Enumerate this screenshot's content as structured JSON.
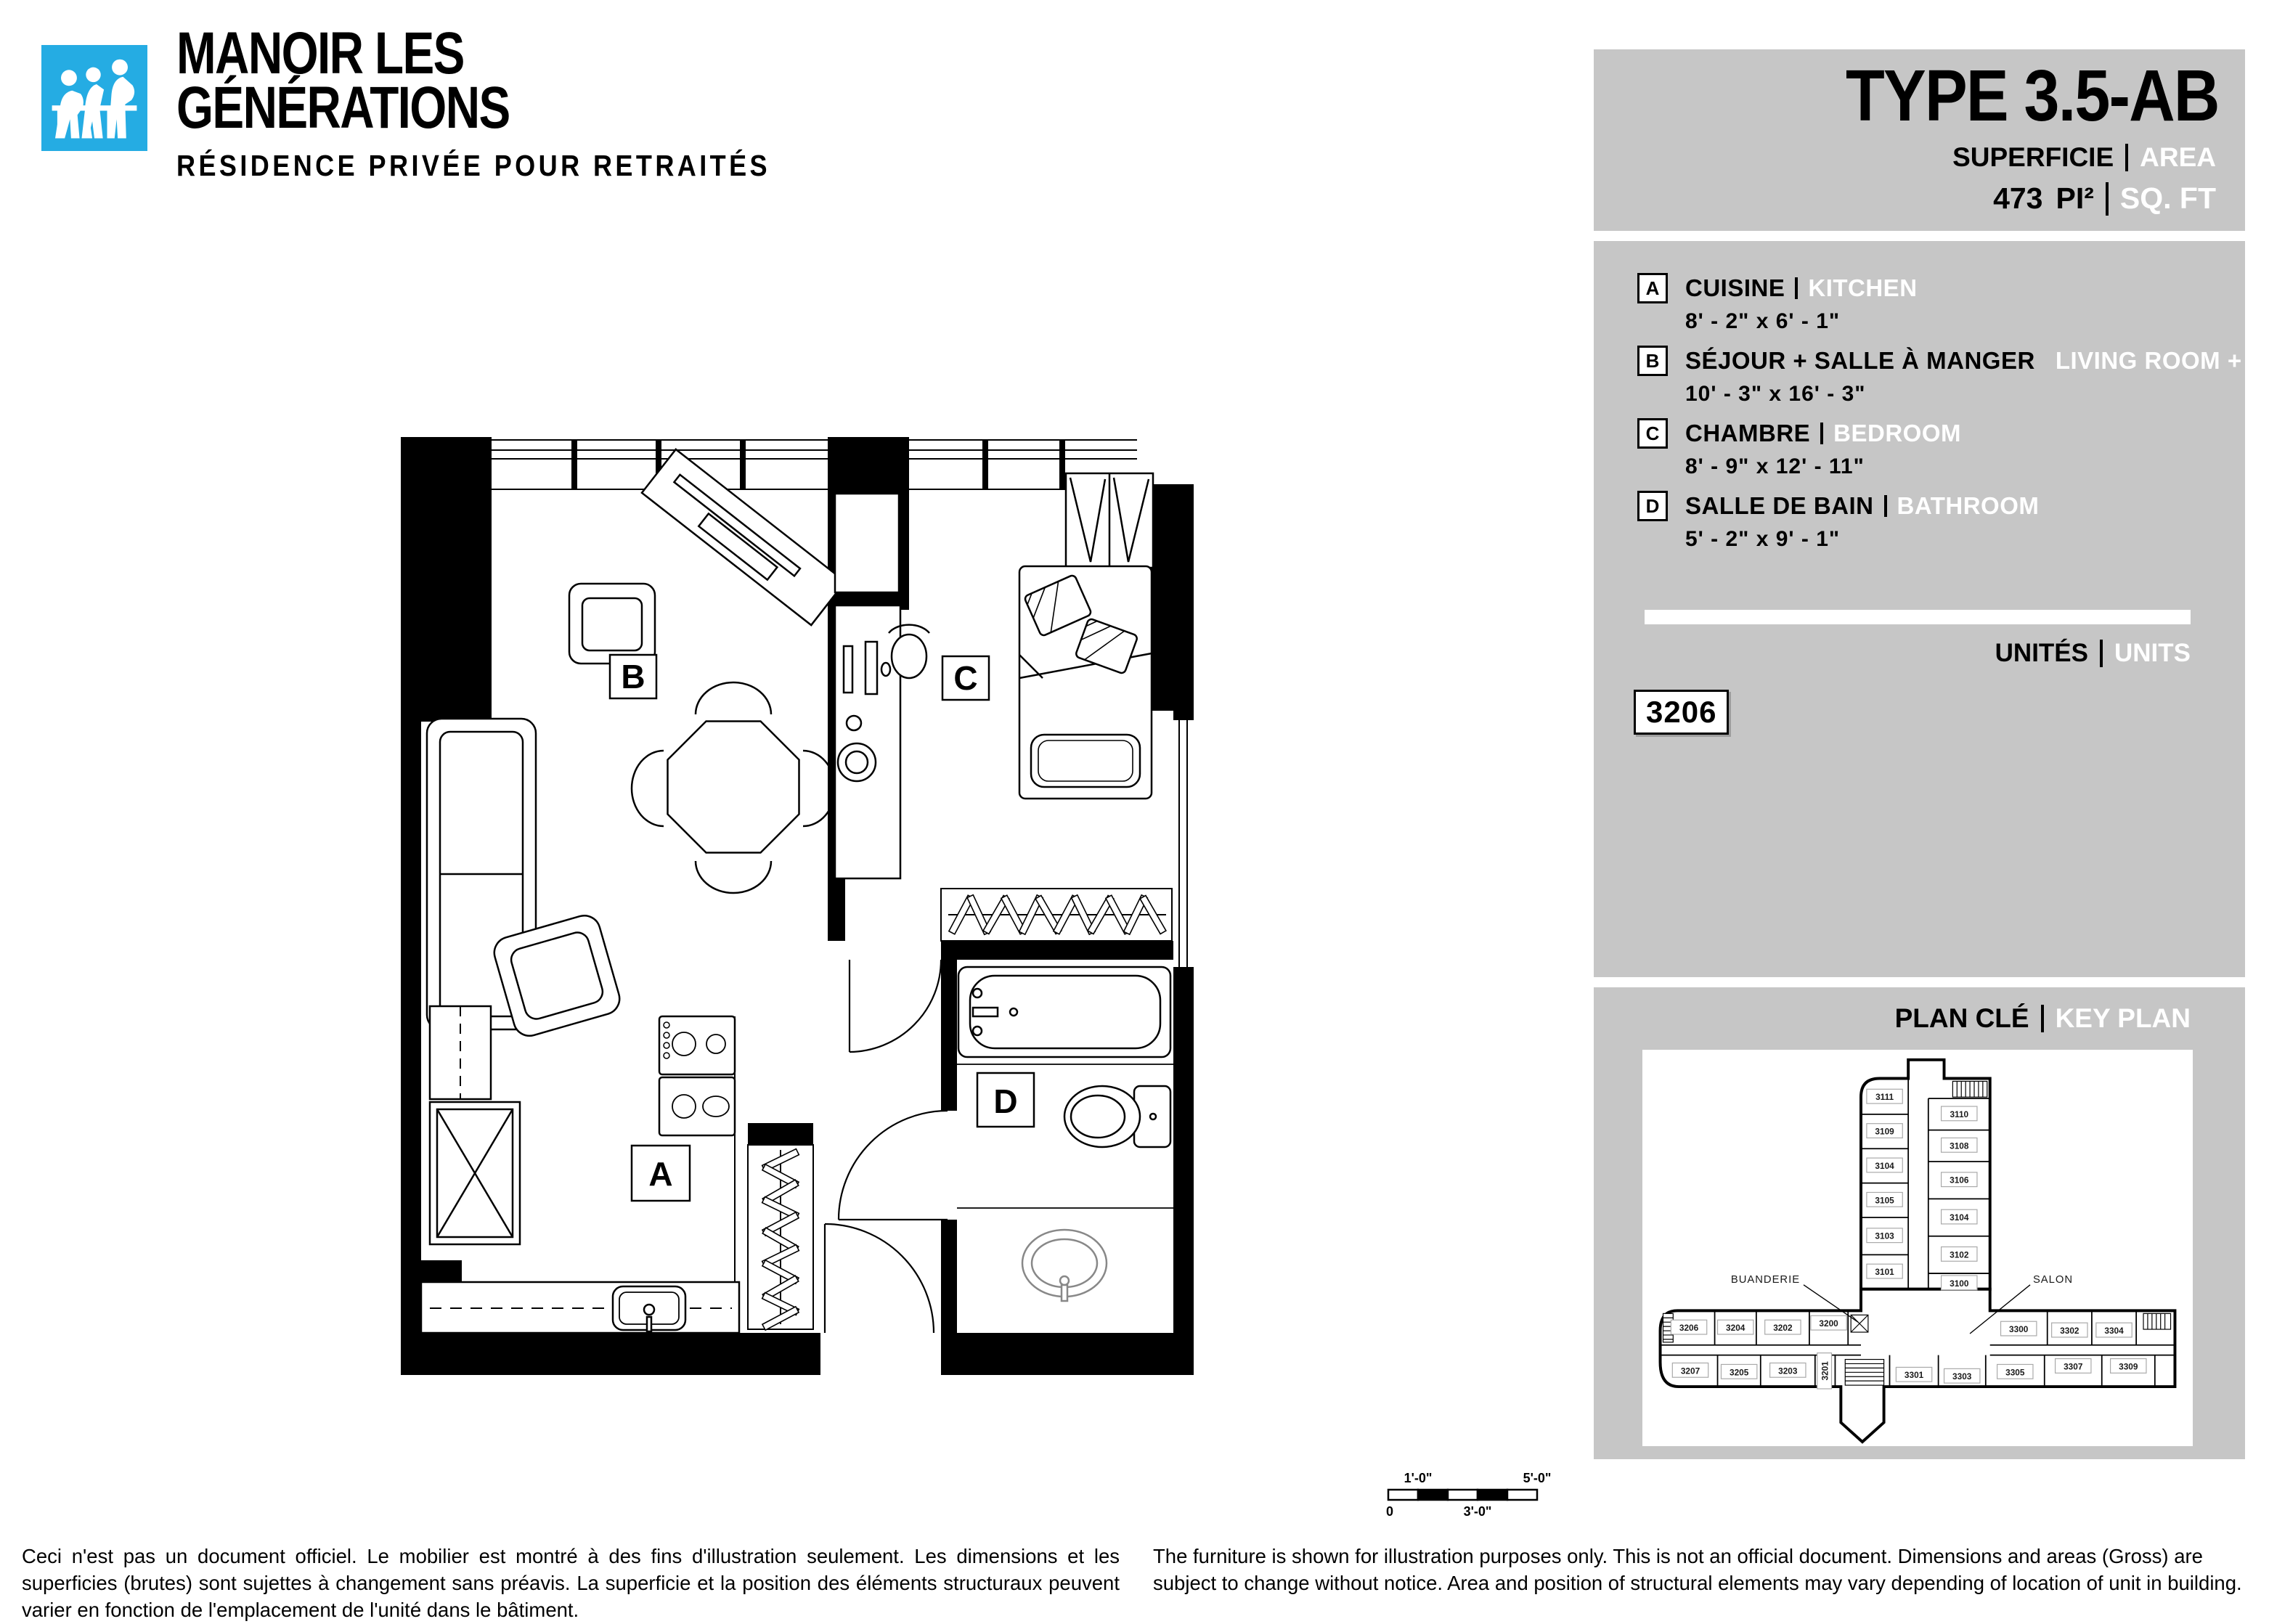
{
  "logo": {
    "brand_line1": "MANOIR LES",
    "brand_line2": "GÉNÉRATIONS",
    "tagline": "RÉSIDENCE PRIVÉE POUR RETRAITÉS",
    "icon_color": "#25ace3"
  },
  "title_panel": {
    "type_label": "TYPE 3.5-AB",
    "superficie_fr": "SUPERFICIE",
    "superficie_en": "AREA",
    "area_value": "473",
    "area_unit_fr": "PI²",
    "area_unit_en": "SQ. FT"
  },
  "legend": {
    "rooms": [
      {
        "letter": "A",
        "name_fr": "CUISINE",
        "name_en": "KITCHEN",
        "dimensions": "8' - 2\" x 6' - 1\""
      },
      {
        "letter": "B",
        "name_fr": "SÉJOUR + SALLE À MANGER",
        "name_en": "LIVING ROOM + DINING",
        "dimensions": "10' - 3\" x 16' - 3\""
      },
      {
        "letter": "C",
        "name_fr": "CHAMBRE",
        "name_en": "BEDROOM",
        "dimensions": "8' - 9\" x 12' - 11\""
      },
      {
        "letter": "D",
        "name_fr": "SALLE DE BAIN",
        "name_en": "BATHROOM",
        "dimensions": "5' - 2\" x 9' - 1\""
      }
    ]
  },
  "units_section": {
    "label_fr": "UNITÉS",
    "label_en": "UNITS",
    "unit_number": "3206"
  },
  "key_plan": {
    "label_fr": "PLAN CLÉ",
    "label_en": "KEY PLAN",
    "annotation_laundry": "BUANDERIE",
    "annotation_lounge": "SALON",
    "tower_left_units": [
      "3111",
      "3109",
      "3104",
      "3105",
      "3103",
      "3101"
    ],
    "tower_right_units": [
      "3110",
      "3108",
      "3106",
      "3104",
      "3102",
      "3100"
    ],
    "wing_top_left_units": [
      "3206",
      "3204",
      "3202",
      "3200"
    ],
    "wing_top_right_units": [
      "3300",
      "3302",
      "3304"
    ],
    "wing_bottom_left_units": [
      "3207",
      "3205",
      "3203",
      "3201"
    ],
    "wing_bottom_right_units": [
      "3301",
      "3303",
      "3305",
      "3307",
      "3309"
    ]
  },
  "scale_bar": {
    "zero": "0",
    "one_ft": "1'-0\"",
    "three_ft": "3'-0\"",
    "five_ft": "5'-0\""
  },
  "disclaimer": {
    "fr": "Ceci n'est pas un document officiel. Le mobilier est montré à des fins d'illustration seulement. Les dimensions et les superficies (brutes) sont sujettes à changement sans préavis. La superficie et la position des éléments structuraux peuvent varier en fonction de l'emplacement de l'unité dans le bâtiment.",
    "en": "The furniture is shown for illustration purposes only. This is not an official document. Dimensions and areas (Gross) are subject to change without notice. Area and position of structural elements may vary depending of location of unit in building."
  },
  "colors": {
    "accent": "#25ace3",
    "panel_gray": "#c6c6c6",
    "ink": "#000000",
    "en_text": "#ffffff"
  }
}
